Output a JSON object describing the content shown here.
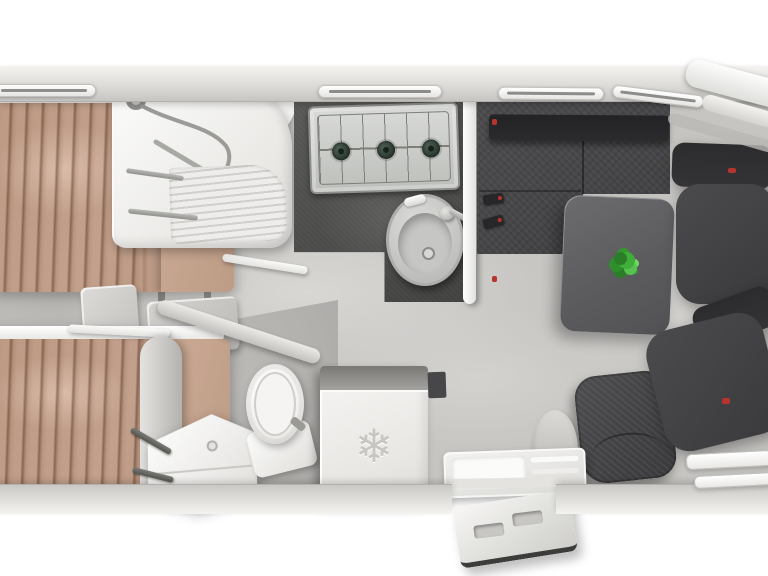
{
  "scene": {
    "label": "Motorhome interior floor plan, top-down 3D render",
    "view": "top-down"
  },
  "palette": {
    "bg_white": "#ffffff",
    "wall_light": "#f0efec",
    "wall_shade": "#cfcecb",
    "floor_base": "#c6c5c2",
    "floor_light": "#d8d7d4",
    "floor_dark": "#b3b2af",
    "counter_dark": "#4e4e4d",
    "sofa_base": "#454547",
    "sofa_backrest": "#2b2b2d",
    "table_gray": "#5c5c5f",
    "seat_gray": "#434345",
    "seat_dark": "#343436",
    "bed_tan": "#c2a08c",
    "bed_tan_light": "#cdab96",
    "curtain_brown": "#8a664d",
    "fixture_white": "#f3f3f1",
    "fixture_shadow": "#d9d8d5",
    "steel_gray": "#9b9b98",
    "hob_gray": "#c9cbc7",
    "burner_green": "#2c3a31",
    "plant_green": "#3fae3a",
    "accent_red": "#b5342f",
    "window_slit": "#8c8c8a"
  },
  "rooms": {
    "bedroom": {
      "label": "Rear bedroom with two single beds and steps"
    },
    "bathroom": {
      "label": "Washroom with shower, washbasin and toilet"
    },
    "kitchen": {
      "label": "Kitchen with 3-burner hob, round sink and dark worktop"
    },
    "lounge": {
      "label": "Lounge with L-shaped sofa, table and plant"
    },
    "cab": {
      "label": "Driver cab with two swivelled seats"
    },
    "entry": {
      "label": "Entrance door with interior and exterior steps"
    }
  },
  "furniture": {
    "bed_top": {
      "label": "Single bed (upper) with tan bedding"
    },
    "bed_bottom": {
      "label": "Single bed (lower) with tan bedding"
    },
    "bed_steps": {
      "label": "Bedroom access steps",
      "count": 2
    },
    "shower": {
      "label": "Corner shower cabin with ribbed door"
    },
    "worktop": {
      "label": "Dark L-shaped kitchen worktop"
    },
    "hob": {
      "label": "Gas hob",
      "burner_count": 3
    },
    "sink": {
      "label": "Round kitchen sink with faucet"
    },
    "divider": {
      "label": "Partition wall between kitchen and lounge"
    },
    "sofa": {
      "label": "L-shaped lounge sofa, charcoal fabric"
    },
    "table": {
      "label": "Dinette table"
    },
    "plant": {
      "label": "Green plant on table"
    },
    "chair": {
      "label": "Single dinette chair"
    },
    "seat_driver": {
      "label": "Cab seat (top), swivelled"
    },
    "seat_passenger": {
      "label": "Cab seat (bottom), swivelled"
    },
    "washbasin": {
      "label": "Corner washbasin with taps"
    },
    "toilet": {
      "label": "Toilet"
    },
    "fridge": {
      "label": "Fridge",
      "icon": "snowflake-icon",
      "icon_glyph": "❄"
    },
    "entry_step_inner": {
      "label": "Interior entry step"
    },
    "entry_step_outer": {
      "label": "Exterior folding entry step"
    },
    "windows": {
      "label": "Slot windows in side walls",
      "count": 6
    }
  }
}
